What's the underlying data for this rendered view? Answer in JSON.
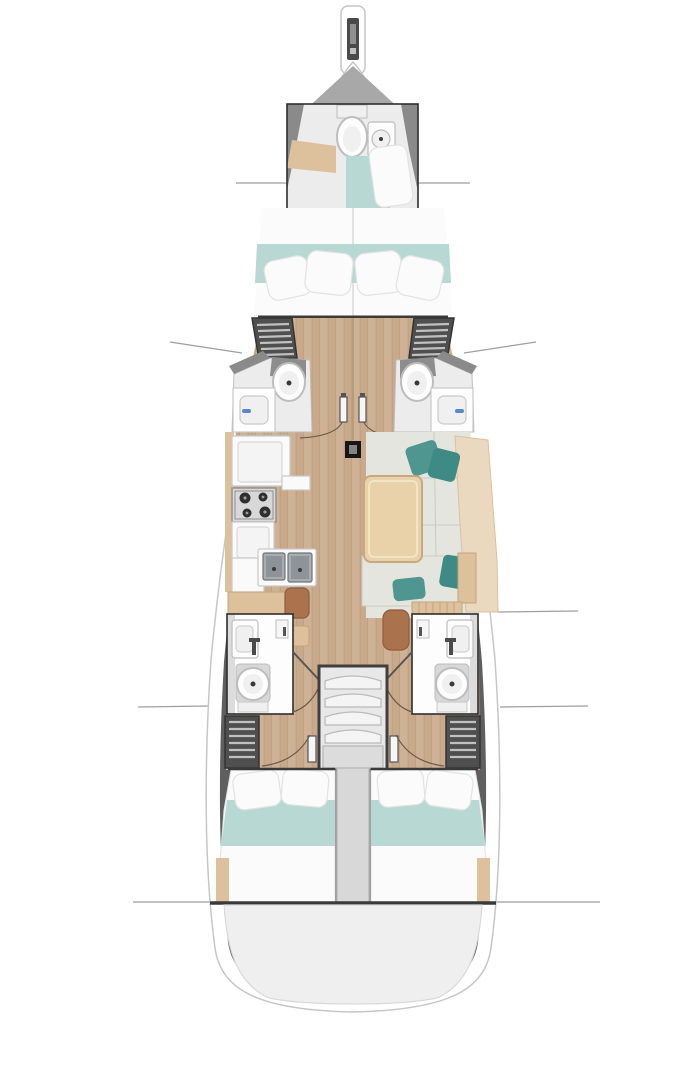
{
  "diagram": {
    "type": "yacht-floor-plan",
    "orientation": "bow-up",
    "sections": [
      "bowsprit",
      "bow-head",
      "v-berth-cabin",
      "mid-wardrobes",
      "port-mid-head",
      "starboard-mid-head",
      "galley",
      "salon",
      "salon-table",
      "nav-seat",
      "port-aft-head",
      "starboard-aft-head",
      "companionway-stairs",
      "port-aft-cabin",
      "starboard-aft-cabin",
      "transom-platform"
    ],
    "fixtures": [
      "toilet",
      "sink",
      "shower-mixer",
      "stove-burners",
      "double-sink",
      "door-swing-arc",
      "mast-post",
      "louvered-locker",
      "pillow",
      "teal-bed-runner",
      "wood-table",
      "chair"
    ]
  },
  "colors": {
    "background": "#ffffff",
    "section_line": "#9e9e9e",
    "hull_white": "#ffffff",
    "hull_edge": "#c6c6c6",
    "hull_band": "#5f5f5f",
    "bow_wedge": "#a8a8a8",
    "wall_gray": "#8a8a8a",
    "box_line": "#2e2e2e",
    "head_floor": "#ececec",
    "fixture_white": "#fdfdfd",
    "fixture_edge": "#bdbdbd",
    "fixture_inner": "#f0f0f0",
    "fixture_dot": "#3a3a3a",
    "pedestal_gray": "#8d8d8d",
    "wood_floor": "#c8a98a",
    "wood_floor_light": "#cfb296",
    "wood_seam": "#a98a6c",
    "wood_trim": "#ddc19c",
    "wood_slat_edge": "#c3a47e",
    "bed_white": "#fbfbfb",
    "bed_edge": "#e2e2e2",
    "teal_bed": "#b7d8d3",
    "teal_pillow": "#4e968f",
    "teal_dark": "#3e8a84",
    "salon_floor": "#e4e5df",
    "tile_seam": "#c9cbc3",
    "bench_back": "#ead9bf",
    "bench_edge": "#d8c2a0",
    "table_wood": "#e9d2aa",
    "table_edge": "#c8a87c",
    "table_inner": "#f3e4c6",
    "chair_brown": "#aa724d",
    "chair_edge": "#8e5c3e",
    "locker": "#4f4f4f",
    "locker_edge": "#343434",
    "locker_slat": "#c0c0c0",
    "counter_white": "#fafafa",
    "counter_edge": "#c9c9c9",
    "counter_door": "#f4f4f4",
    "counter_door_edge": "#d8d8d8",
    "stove_body": "#d8d8d8",
    "stove_edge": "#8f8f8f",
    "burner": "#2f2f2f",
    "burner_dot": "#9a9a9a",
    "sink_steel": "#a7adb1",
    "sink_steel_dark": "#8d9398",
    "sink_edge": "#6f7478",
    "stairs_frame": "#3f3f3f",
    "stairs_bg": "#e8e8e8",
    "tread": "#f4f4f4",
    "tread_edge": "#b9b9b9",
    "landing": "#dcdcdc",
    "landing_edge": "#b5b5b5",
    "divider": "#d8d8d8",
    "divider_edge": "#bdbdbd",
    "platform": "#efefef",
    "platform_edge": "#d9d9d9",
    "bulkhead": "#3a3a3a",
    "arc_line": "#6b5b49",
    "door_leaf": "#f6f6f6",
    "door_leaf_edge": "#555555",
    "mast": "#161616",
    "mast_inner": "#848484",
    "blue_accent": "#5b86d8",
    "mixer_dark": "#4a4a4a",
    "slot_dark": "#4a4a4a",
    "slot_light": "#909090"
  }
}
